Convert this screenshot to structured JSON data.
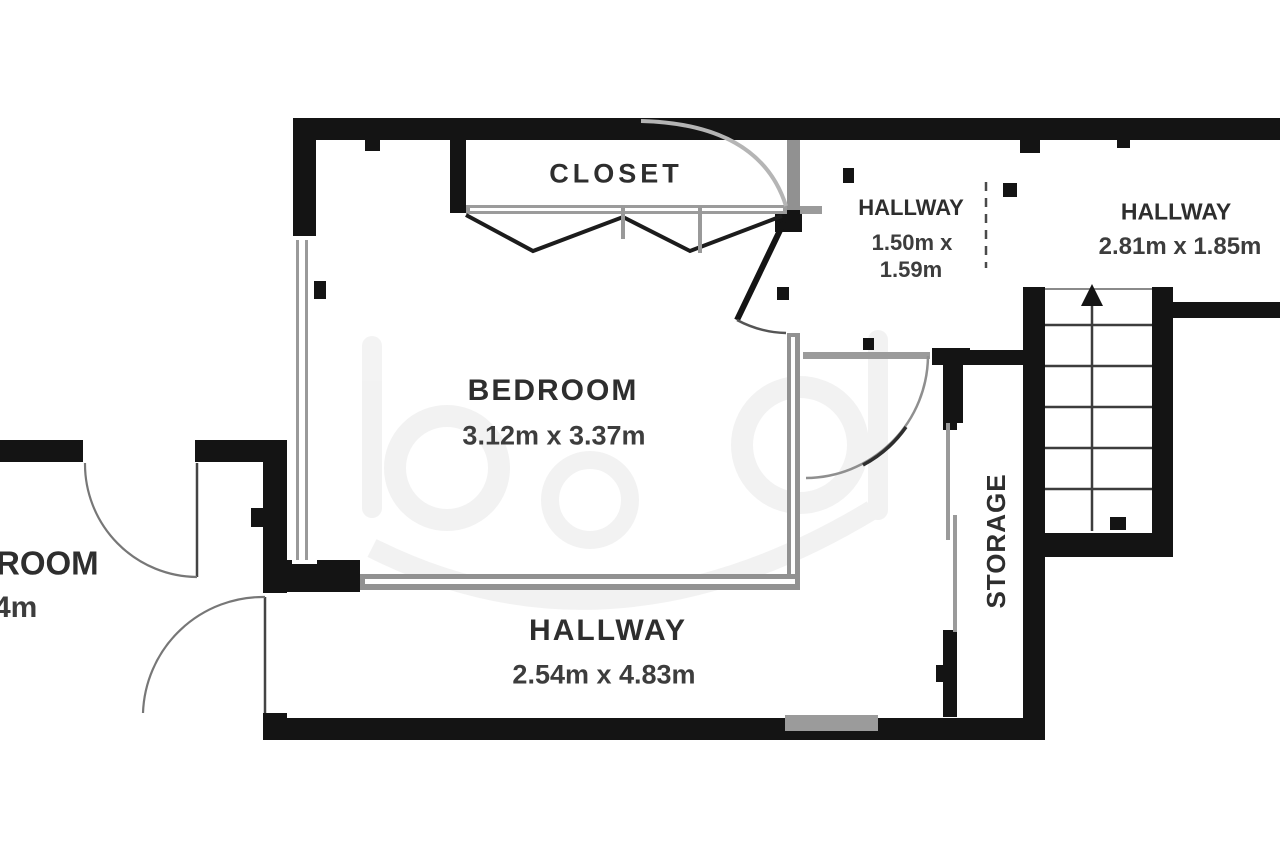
{
  "floorplan": {
    "rooms": {
      "closet": {
        "name": "CLOSET"
      },
      "bedroom": {
        "name": "BEDROOM",
        "dimensions": "3.12m x 3.37m"
      },
      "hallway_small": {
        "name": "HALLWAY",
        "dimensions_line1": "1.50m x",
        "dimensions_line2": "1.59m"
      },
      "hallway_top_right": {
        "name": "HALLWAY",
        "dimensions": "2.81m x 1.85m"
      },
      "hallway_bottom": {
        "name": "HALLWAY",
        "dimensions": "2.54m x 4.83m"
      },
      "storage": {
        "name": "STORAGE"
      },
      "left_room_partial": {
        "name_visible": "ROOM",
        "dimensions_visible": "4m"
      }
    },
    "stairs": {
      "direction": "up",
      "tread_lines": 5
    },
    "colors": {
      "wall": "#141414",
      "highlight_wall": "#919191",
      "label_text": "#2e2e2e",
      "background": "#ffffff"
    }
  }
}
